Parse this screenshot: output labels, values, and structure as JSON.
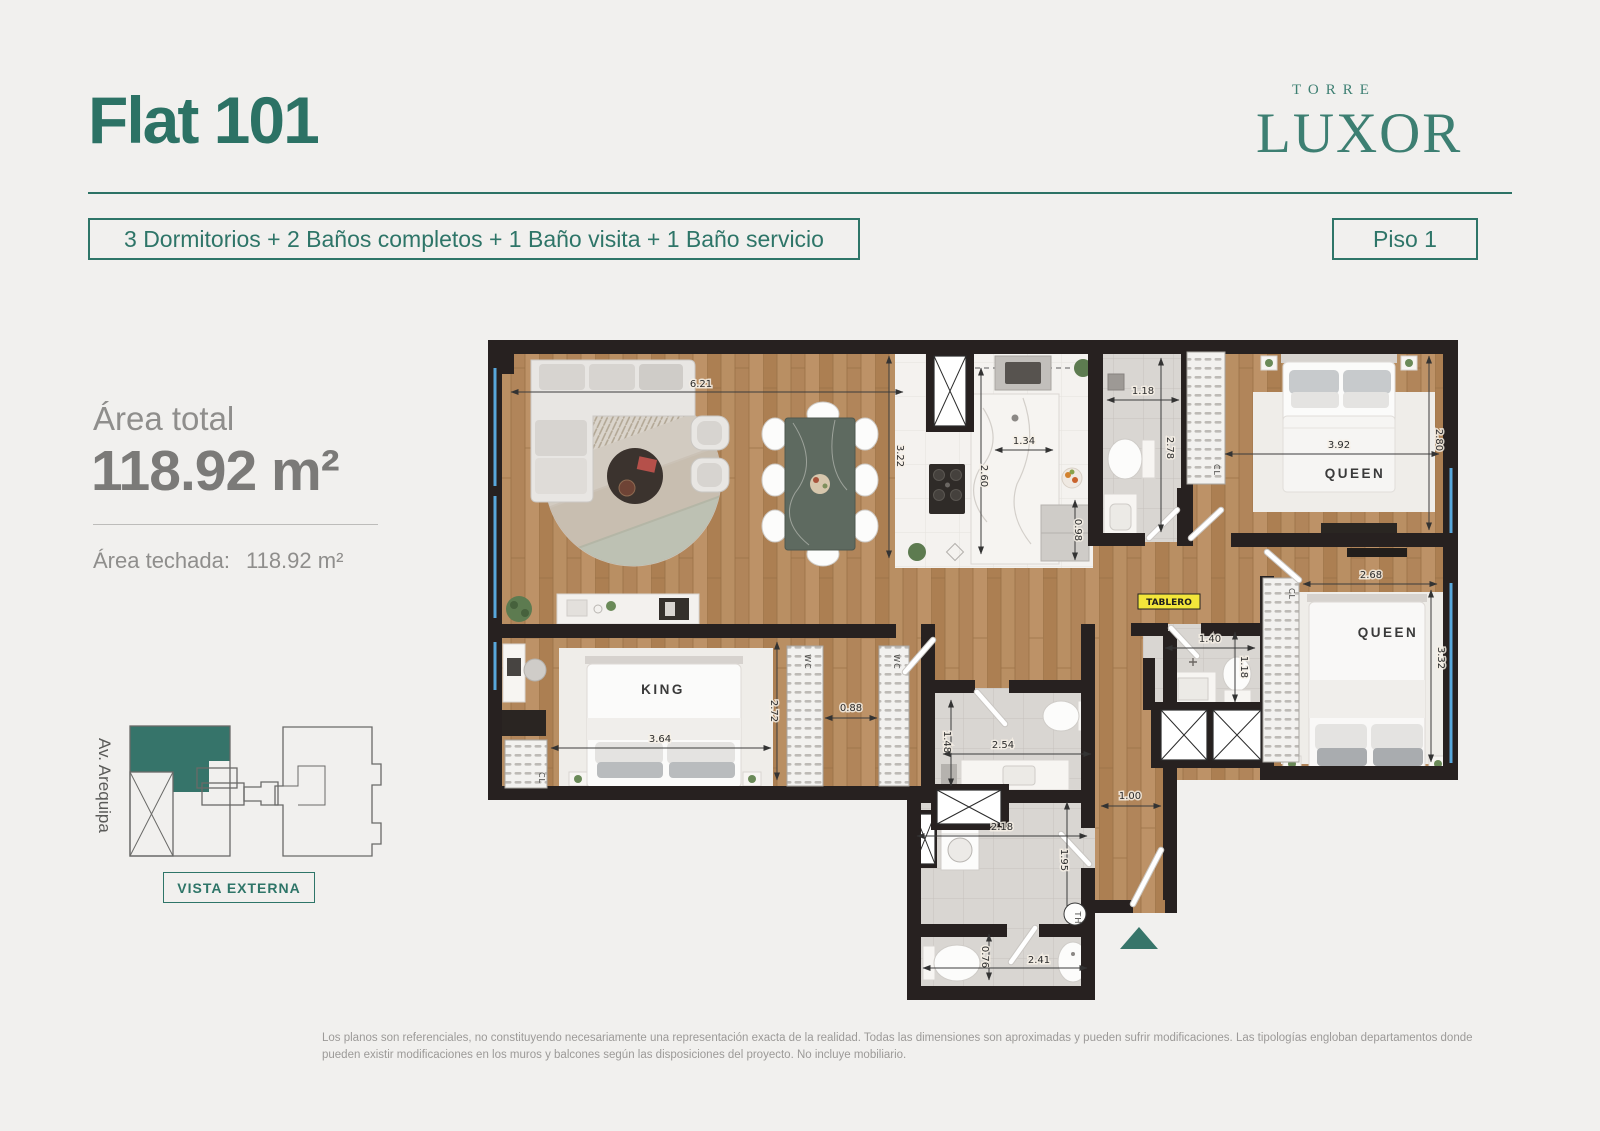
{
  "header": {
    "title": "Flat 101",
    "typology": "3 Dormitorios + 2 Baños completos + 1 Baño visita + 1 Baño servicio",
    "floor_badge": "Piso 1",
    "brand_top": "TORRE",
    "brand_name": "LUXOR"
  },
  "area": {
    "total_label": "Área total",
    "total_value": "118.92 m²",
    "techada_label": "Área techada:",
    "techada_value": "118.92 m²"
  },
  "key_plan": {
    "street": "Av. Arequipa",
    "view_label": "VISTA EXTERNA"
  },
  "plan": {
    "labels": {
      "bed_king": "KING",
      "bed_queen1": "QUEEN",
      "bed_queen2": "QUEEN",
      "closet_queen1": "CL",
      "closet_queen2": "CL",
      "closet_king": "CL",
      "walkin1": "WC",
      "walkin2": "WC",
      "tablero": "TABLERO",
      "th": "TH"
    },
    "dims": {
      "living_width": "6.21",
      "living_depth": "3.22",
      "kitchen_width": "1.34",
      "kitchen_depth": "2.60",
      "kitchen_pass": "0.98",
      "bath1_width": "1.18",
      "bath1_depth": "2.78",
      "bedroom1_width": "3.92",
      "bedroom1_depth": "2.80",
      "bedroom2_width": "2.68",
      "bedroom2_depth": "3.32",
      "bath_visita_width": "1.40",
      "bath_visita_depth": "1.18",
      "king_width": "3.64",
      "king_depth": "2.72",
      "closet_gap": "0.88",
      "bath2_depth": "1.48",
      "bath2_width": "2.54",
      "laundry_depth": "1.95",
      "laundry_width": "2.18",
      "hall_width": "1.00",
      "bath_service_depth": "0.76",
      "bath_service_width": "2.41"
    }
  },
  "footer": {
    "disclaimer": "Los planos son referenciales, no constituyendo necesariamente una representación exacta de la realidad. Todas las dimensiones son aproximadas y pueden sufrir modificaciones.  Las tipologías engloban departamentos donde pueden existir modificaciones en los muros y balcones según las disposiciones del proyecto. No incluye mobiliario."
  },
  "colors": {
    "accent_teal": "#2e7568",
    "wall_dark": "#272120",
    "wood": "#b48a5e",
    "window_blue": "#58a8dc",
    "tablero_yellow": "#f3e63a"
  }
}
